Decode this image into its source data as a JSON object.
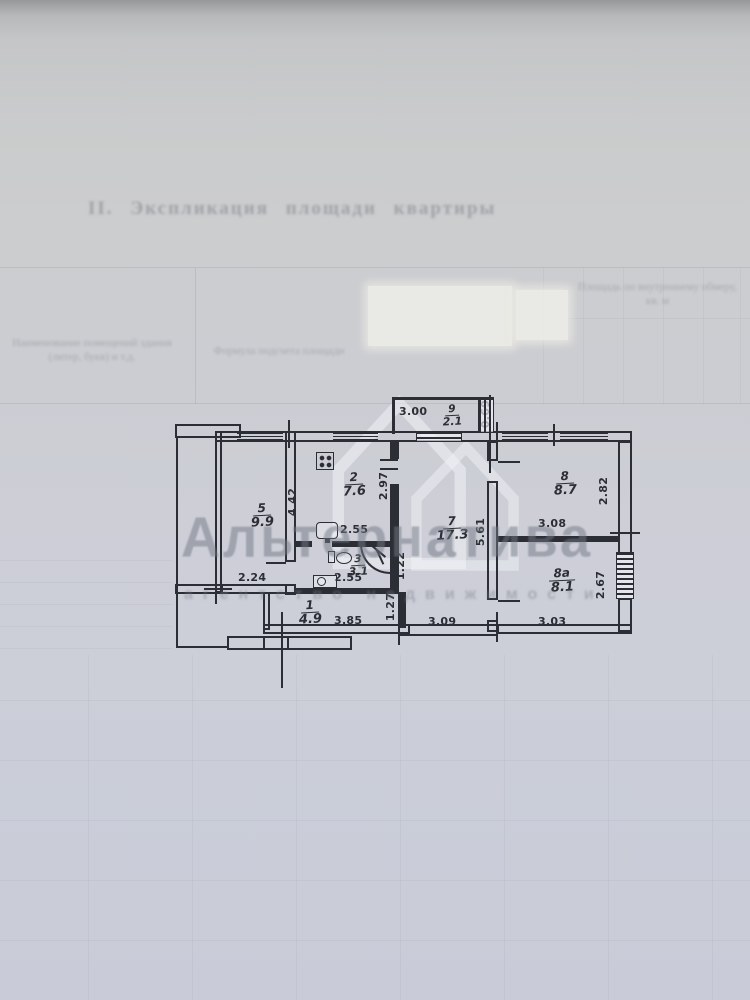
{
  "page": {
    "header_faded": "II. Экспликация площади квартиры",
    "table_headers": {
      "col1": "Наименование помещений здания (литер, букв) и т.д.",
      "col2": "Формула подсчета площади",
      "col3": "Площадь по внутреннему обмеру, кв. м"
    }
  },
  "watermark": {
    "brand": "Альтернатива",
    "tagline": "агентство недвижимости"
  },
  "plan": {
    "rooms": [
      {
        "num": "9",
        "area": "2.1"
      },
      {
        "num": "2",
        "area": "7.6"
      },
      {
        "num": "5",
        "area": "9.9"
      },
      {
        "num": "3",
        "area": "3.1"
      },
      {
        "num": "1",
        "area": "4.9"
      },
      {
        "num": "7",
        "area": "17.3"
      },
      {
        "num": "8",
        "area": "8.7"
      },
      {
        "num": "8а",
        "area": "8.1"
      }
    ],
    "dims": {
      "w300": "3.00",
      "h069": "0.69",
      "h297": "2.97",
      "w255k": "2.55",
      "h442": "4.42",
      "w224": "2.24",
      "w255b": "2.55",
      "h122": "1.22",
      "h127": "1.27",
      "w385": "3.85",
      "w309": "3.09",
      "h561": "5.61",
      "h282": "2.82",
      "w308": "3.08",
      "h267": "2.67",
      "w303": "3.03"
    }
  }
}
